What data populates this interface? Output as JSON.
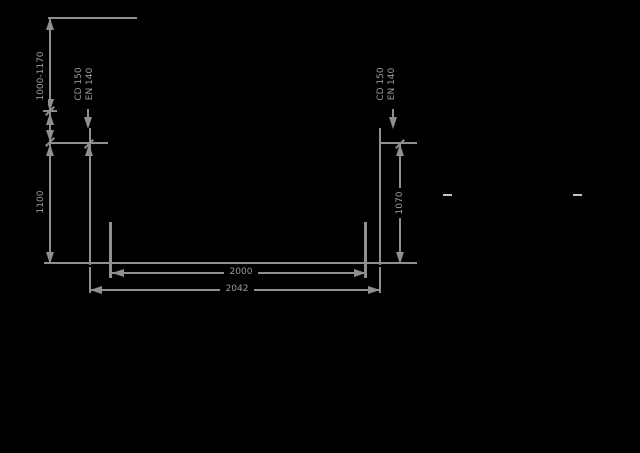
{
  "canvas": {
    "background": "#000000",
    "line_color": "#8f8f8f",
    "text_color": "#9c9c9c",
    "dash_color": "#c4c4c4"
  },
  "drawing": {
    "type": "channel-cross-section",
    "dimensions": {
      "depth_range": "1000-1170",
      "left_depth": "1100",
      "right_depth": "1070",
      "inner_width": "2000",
      "outer_width": "2042"
    },
    "labels": {
      "left_edge": {
        "line1": "CD 150",
        "line2": "EN 140"
      },
      "right_edge": {
        "line1": "CD 150",
        "line2": "EN 140"
      }
    }
  }
}
